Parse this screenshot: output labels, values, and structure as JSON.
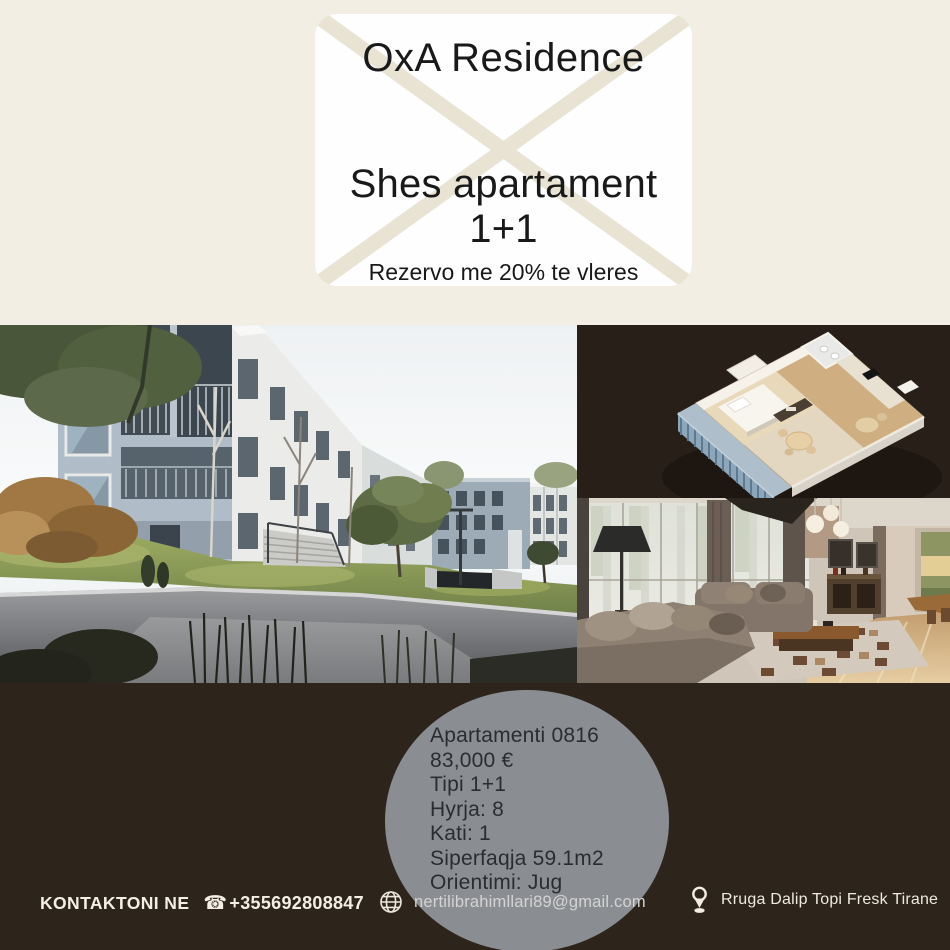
{
  "header": {
    "brand": "OxA Residence",
    "headline": "Shes apartament 1+1",
    "promo": "Rezervo me 20% te vleres"
  },
  "listing": {
    "unit": "Apartamenti 0816",
    "price": "83,000 €",
    "type": "Tipi 1+1",
    "entrance": "Hyrja: 8",
    "floor": "Kati: 1",
    "area": "Siperfaqja 59.1m2",
    "orientation": "Orientimi: Jug"
  },
  "footer": {
    "contact_label": "KONTAKTONI NE",
    "phone_icon": "☎",
    "phone": "+355692808847",
    "email": "nertilibrahimllari89@gmail.com",
    "address": "Rruga Dalip Topi Fresk Tirane"
  },
  "icons": [
    "envelope-graphic",
    "globe-icon",
    "location-pin-icon",
    "phone-icon"
  ],
  "colors": {
    "header_background": "#f2eee3",
    "envelope_fold": "#e9e3d4",
    "footer_background": "#2d241c",
    "floorplan_background": "#281f18",
    "detail_circle": "#8a8e93",
    "detail_text": "#2b2c30"
  }
}
